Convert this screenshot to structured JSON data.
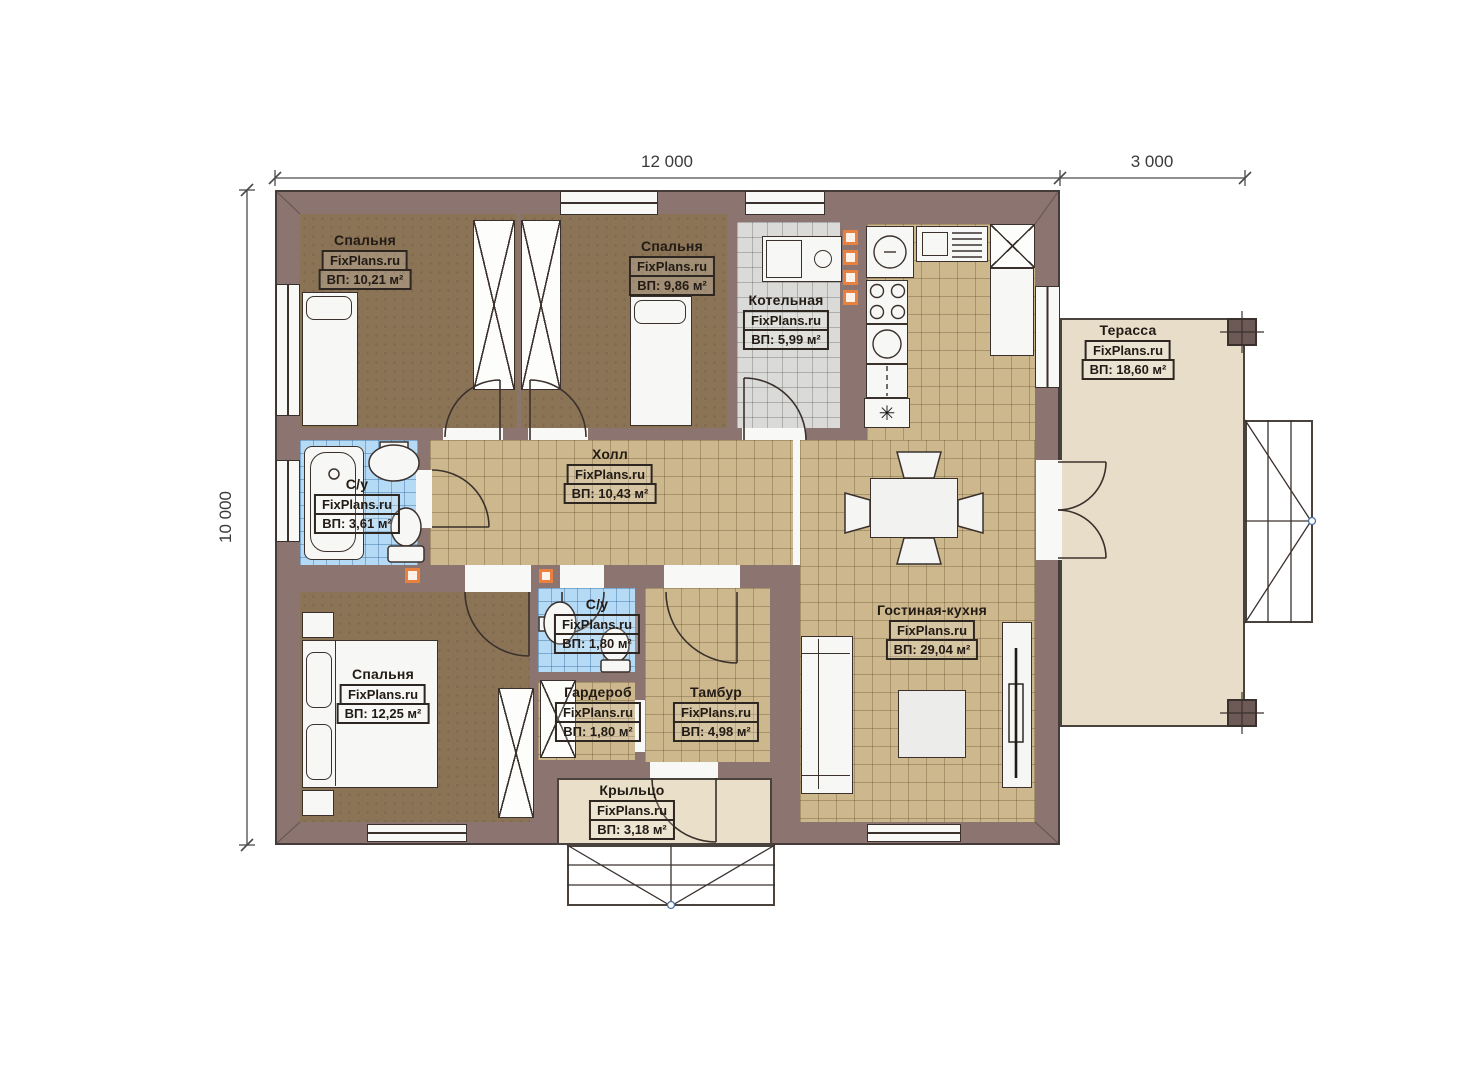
{
  "brand": "FixPlans.ru",
  "dimensions": {
    "top_width": "12 000",
    "terrace_width": "3 000",
    "left_height": "10 000"
  },
  "rooms": {
    "bedroom_tl": {
      "name": "Спальня",
      "area": "ВП: 10,21 м²"
    },
    "bedroom_tm": {
      "name": "Спальня",
      "area": "ВП: 9,86 м²"
    },
    "boiler": {
      "name": "Котельная",
      "area": "ВП: 5,99 м²"
    },
    "terrace": {
      "name": "Терасса",
      "area": "ВП: 18,60 м²"
    },
    "hall": {
      "name": "Холл",
      "area": "ВП: 10,43 м²"
    },
    "bath_main": {
      "name": "С/у",
      "area": "ВП: 3,61 м²"
    },
    "bedroom_bl": {
      "name": "Спальня",
      "area": "ВП: 12,25 м²"
    },
    "bath_small": {
      "name": "С/у",
      "area": "ВП: 1,80 м²"
    },
    "wardrobe": {
      "name": "Гардероб",
      "area": "ВП: 1,80 м²"
    },
    "vestibule": {
      "name": "Тамбур",
      "area": "ВП: 4,98 м²"
    },
    "living_kitchen": {
      "name": "Гостиная-кухня",
      "area": "ВП: 29,04 м²"
    },
    "porch": {
      "name": "Крыльцо",
      "area": "ВП: 3,18 м²"
    }
  },
  "symbols": {
    "hvac_marker": "✳"
  },
  "colors": {
    "wall": "#8c7470",
    "floor_wood": "#8b7356",
    "floor_tile_tan": "#cdb88e",
    "floor_tile_gray": "#dadad8",
    "floor_tile_blue": "#b5daf6",
    "terrace": "#e8ddc8",
    "accent_orange": "#e8803f",
    "stair_dot_blue": "#4a6fa5"
  }
}
